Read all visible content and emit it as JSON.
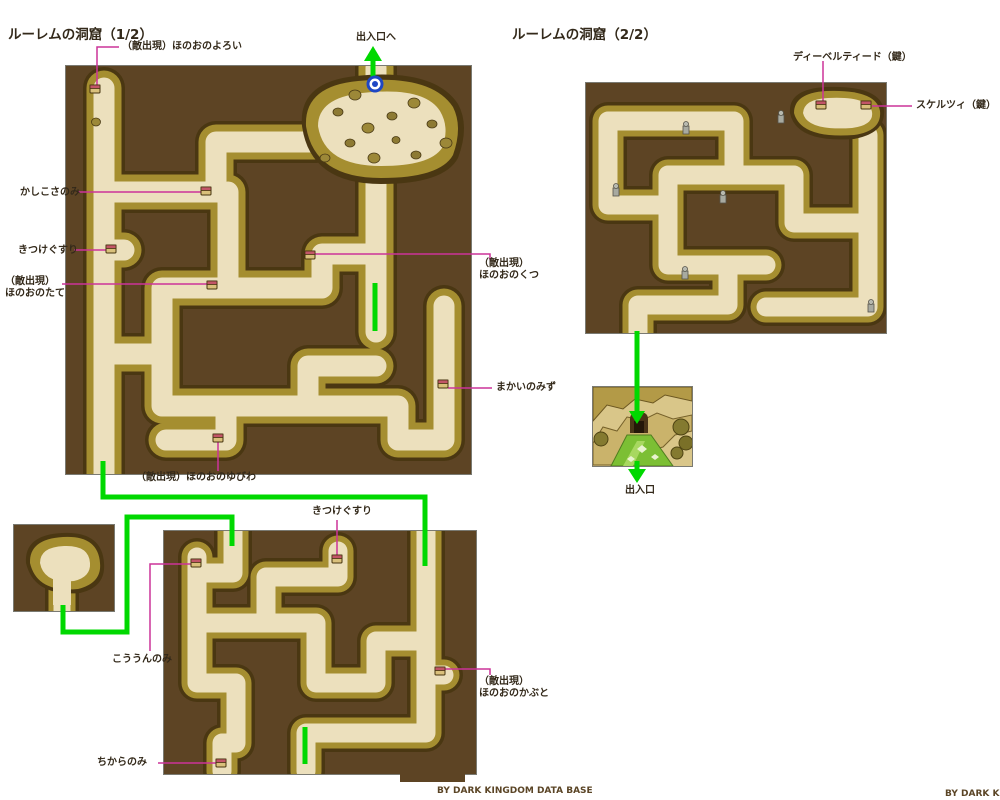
{
  "titles": {
    "map1": "ルーレムの洞窟（1/2）",
    "map2": "ルーレムの洞窟（2/2）"
  },
  "credits": {
    "center": "BY DARK KINGDOM DATA BASE",
    "right": "BY DARK KIN"
  },
  "annotations": {
    "flame_armor": "（敵出現）ほのおのよろい",
    "exit_up": "出入口へ",
    "wisdom_seed": "かしこさのみ",
    "smelling_salts_1": "きつけぐすり",
    "flame_shield": "（敵出現）\nほのおのたて",
    "flame_boots": "（敵出現）\nほのおのくつ",
    "demon_water": "まかいのみず",
    "flame_ring": "（敵出現）ほのおのゆびわ",
    "smelling_salts_2": "きつけぐすり",
    "luck_seed": "こううんのみ",
    "flame_helmet": "（敵出現）\nほのおのかぶと",
    "strength_seed": "ちからのみ",
    "key_item_1": "ディーベルティード（鍵）",
    "key_item_2": "スケルツィ（鍵）",
    "exit": "出入口"
  },
  "colors": {
    "wall_brown": "#5d4424",
    "corridor_rim_dark": "#4a3712",
    "corridor_olive": "#a58e30",
    "floor_tan": "#ece0bd",
    "connector_green": "#00d800",
    "annotation_pink": "#cc3399",
    "entrance_marker_blue": "#1f47c4",
    "grass_green": "#7cbf34",
    "text_dark": "#33291a",
    "credit_brown": "#5b4526"
  }
}
